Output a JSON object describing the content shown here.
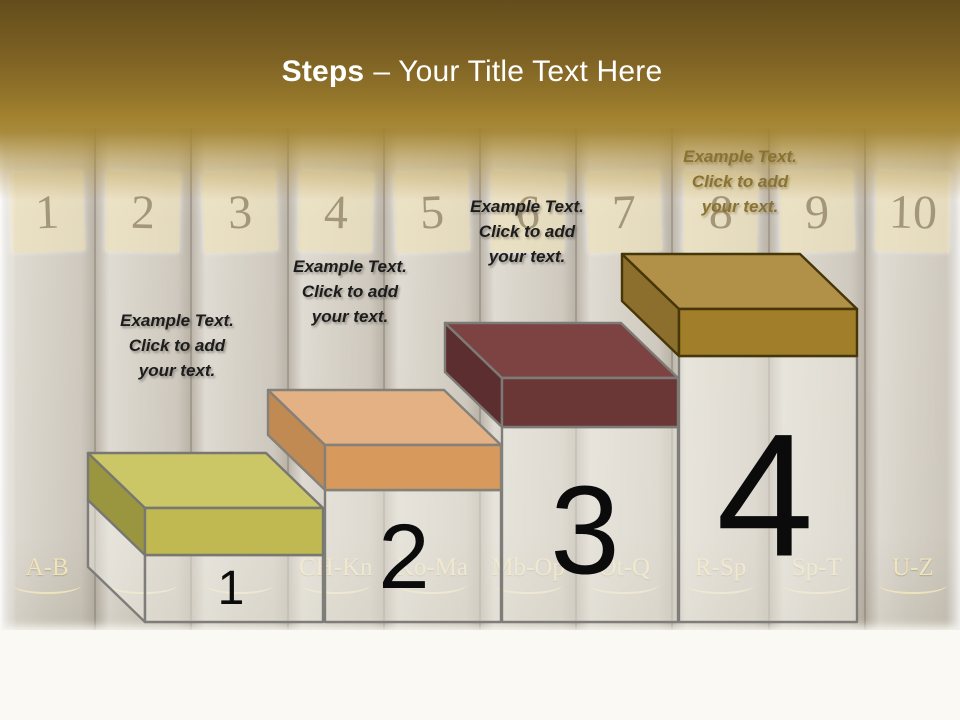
{
  "title": {
    "bold": "Steps",
    "regular": "– Your Title Text Here"
  },
  "steps": [
    {
      "number": "1",
      "placeholder": {
        "lines": [
          "Example Text.",
          "Click  to add",
          "your text."
        ],
        "color": "#1c1c1c"
      },
      "colors": {
        "top": "#cbc766",
        "front": "#c0b951",
        "side": "#9a963f",
        "stroke": "#787771",
        "pedestal_fill": "rgba(240,237,229,0.5)",
        "pedestal_stroke": "#7e7d79"
      }
    },
    {
      "number": "2",
      "placeholder": {
        "lines": [
          "Example Text.",
          "Click  to add",
          "your text."
        ],
        "color": "#1c1c1c"
      },
      "colors": {
        "top": "#e3b183",
        "front": "#d89a5c",
        "side": "#c08a52",
        "stroke": "#84817a",
        "pedestal_fill": "rgba(240,237,229,0.5)",
        "pedestal_stroke": "#7e7d79"
      }
    },
    {
      "number": "3",
      "placeholder": {
        "lines": [
          "Example Text.",
          "Click  to add",
          "your text."
        ],
        "color": "#1c1c1c"
      },
      "colors": {
        "top": "#7d4343",
        "front": "#6b3636",
        "side": "#5d2e30",
        "stroke": "#7d7b76",
        "pedestal_fill": "rgba(240,237,229,0.5)",
        "pedestal_stroke": "#7e7d79"
      }
    },
    {
      "number": "4",
      "placeholder": {
        "lines": [
          "Example Text.",
          "Click  to add",
          "your text."
        ],
        "color": "#8a7331"
      },
      "colors": {
        "top": "#b19048",
        "front": "#a17e29",
        "side": "#8c6f2c",
        "stroke": "#463608",
        "pedestal_fill": "rgba(240,237,229,0.5)",
        "pedestal_stroke": "#7e7d79"
      }
    }
  ],
  "background": {
    "books": [
      {
        "number": "1",
        "label": "A-B"
      },
      {
        "number": "2",
        "label": ""
      },
      {
        "number": "3",
        "label": ""
      },
      {
        "number": "4",
        "label": "CH-Kn"
      },
      {
        "number": "5",
        "label": "Ko-Ma"
      },
      {
        "number": "6",
        "label": "Mb-Op"
      },
      {
        "number": "7",
        "label": "Ot-Q"
      },
      {
        "number": "8",
        "label": "R-Sp"
      },
      {
        "number": "9",
        "label": "Sp-T"
      },
      {
        "number": "10",
        "label": "U-Z"
      }
    ]
  }
}
